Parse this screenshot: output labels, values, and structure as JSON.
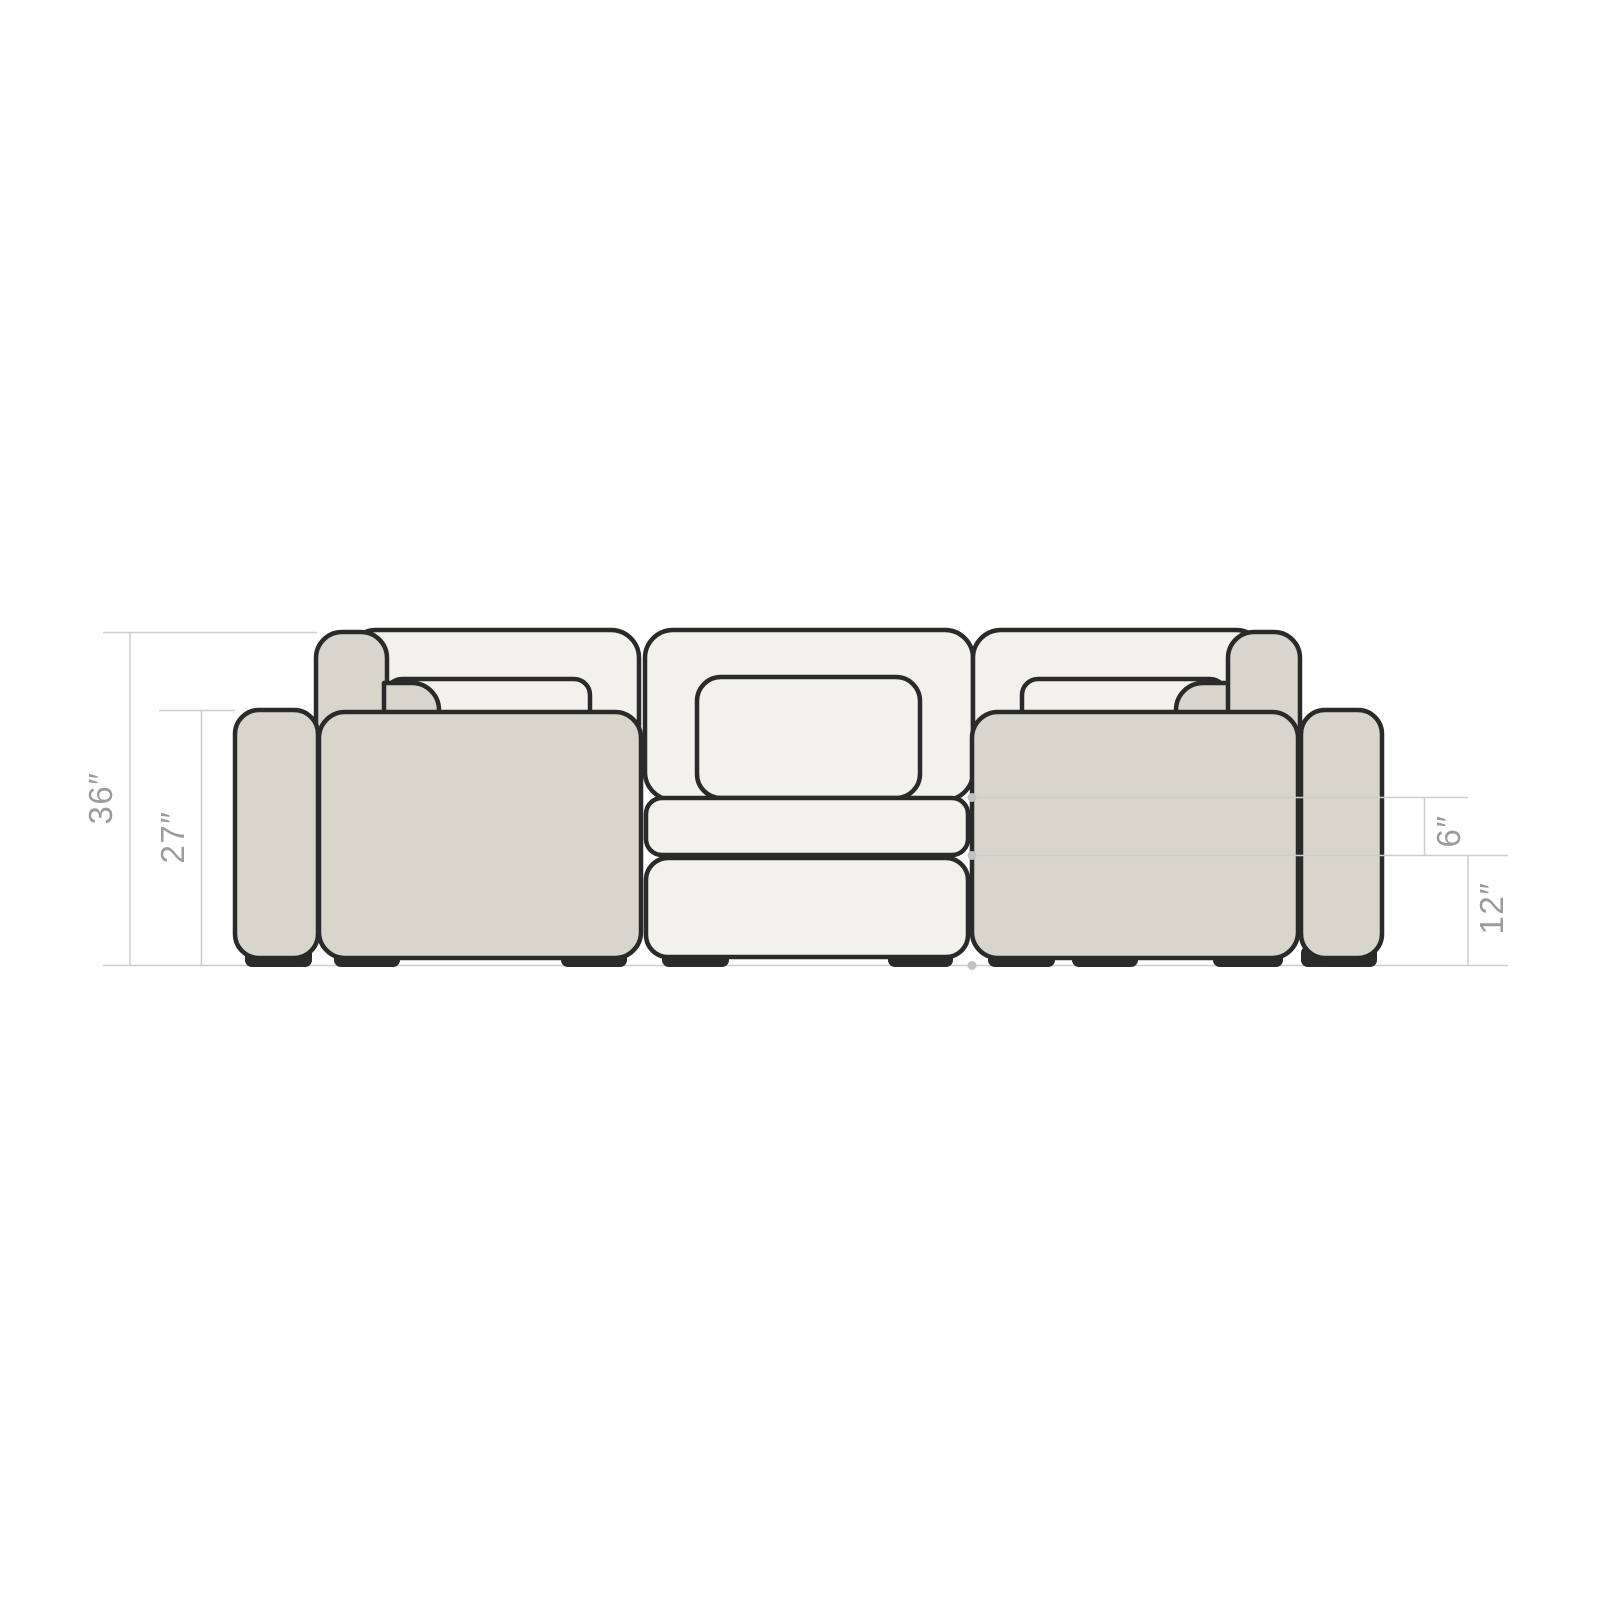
{
  "diagram": {
    "type": "furniture-dimension-diagram",
    "subject": "modular sectional sofa - front elevation",
    "colors": {
      "outline": "#2a2a2a",
      "fabric-light": "#f2f1ec",
      "fabric-gray": "#d8d5cc",
      "feet": "#2b2b2b",
      "dim-line": "#cdcdcb",
      "dim-dot": "#c2c2c0",
      "dim-text": "#9c9c9a",
      "bg": "#ffffff"
    },
    "dimensions": [
      {
        "id": "overall-height",
        "label": "36″",
        "inches": 36
      },
      {
        "id": "arm-seat-height",
        "label": "27″",
        "inches": 27
      },
      {
        "id": "cushion-thickness",
        "label": "6″",
        "inches": 6
      },
      {
        "id": "base-height",
        "label": "12″",
        "inches": 12
      }
    ]
  }
}
